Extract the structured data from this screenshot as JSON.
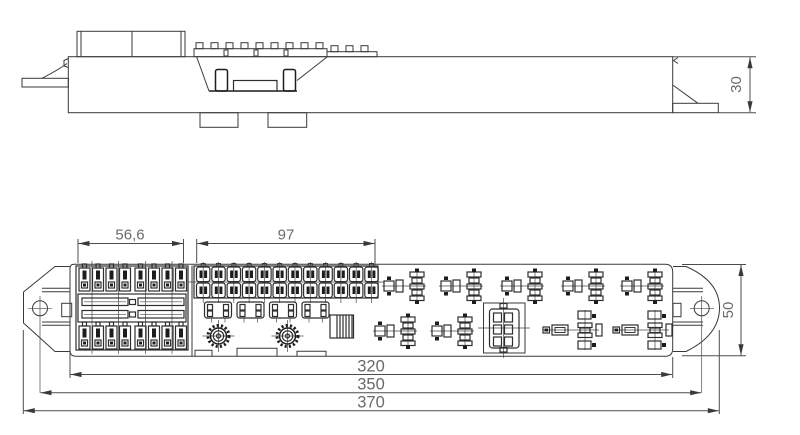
{
  "drawing": {
    "dims": {
      "side_height": "30",
      "fuse_block_width": "56,6",
      "connector_row_width": "97",
      "body_length": "320",
      "mount_hole_span": "350",
      "overall_length": "370",
      "body_depth": "50"
    }
  }
}
